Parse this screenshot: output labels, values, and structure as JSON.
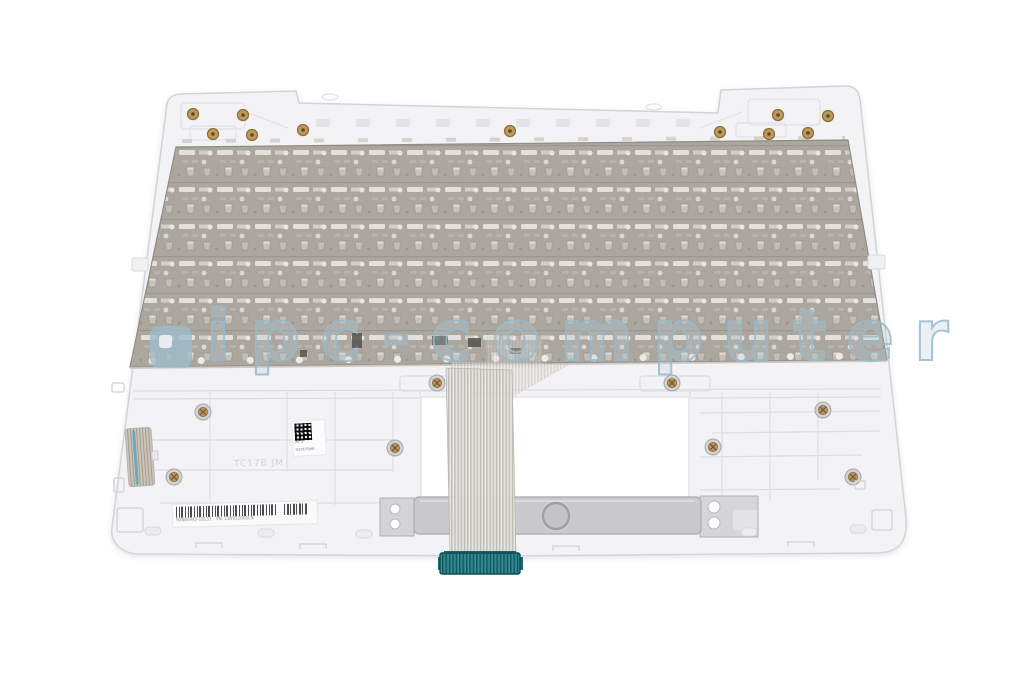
{
  "image": {
    "description": "Product photo: rear view of a white laptop palmrest/top-case with mounted keyboard metal backplate and keyboard flex ribbon cable with teal connector",
    "background_color": "#ffffff"
  },
  "watermark": {
    "logo": "ipc-computer-logo",
    "text": "ipc-computer",
    "color": "#a9c3d1"
  },
  "part": {
    "case_color": "#f3f3f6",
    "keyboard_plate_color": "#aaa59d",
    "ribbon_cable_connector_color": "#2a7d86",
    "touchpad_plate_color": "#cacacd",
    "screw_brass_color": "#b3905a",
    "screw_silver_color": "#d2d2d5",
    "speaker_grille_accent": "#6fa8ba"
  },
  "labels": {
    "barcode": {
      "micro_left": "90NB0943-10133",
      "micro_right": "PN: 13NV2200SCN"
    },
    "datamatrix": {
      "side_text": "AC 1",
      "bottom_text": "G201TQA6"
    },
    "molded_text": "TC17B JM"
  }
}
